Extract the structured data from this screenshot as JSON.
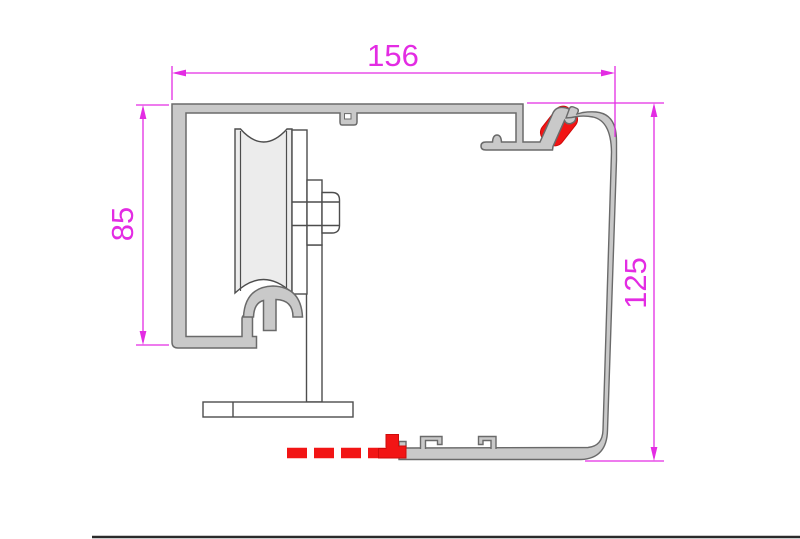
{
  "diagram": {
    "type": "technical-drawing",
    "description": "Cross-section of a sliding gate track profile with guide roller on stand",
    "dimensions": {
      "width": {
        "value": "156"
      },
      "track_height": {
        "value": "85"
      },
      "profile_height": {
        "value": "125"
      }
    },
    "colors": {
      "dimension_magenta": "#e32ce3",
      "profile_fill": "#c9c9c9",
      "profile_stroke": "#6a6a6a",
      "seal_red": "#f21515",
      "hardware_stroke": "#4d4d4d",
      "wheel_fill": "#ececec"
    },
    "components": {
      "track_profile": "c-track-profile",
      "cover_profile": "cover-profile",
      "roller_wheel": "grooved-guide-wheel",
      "axle_bolt": "hex-axle-bolt",
      "support_post": "support-post",
      "base_plate": "base-plate",
      "rail_cap": "rail-cap",
      "top_seal": "rubber-seal",
      "bottom_seal": "brush-seal-dashes"
    }
  }
}
